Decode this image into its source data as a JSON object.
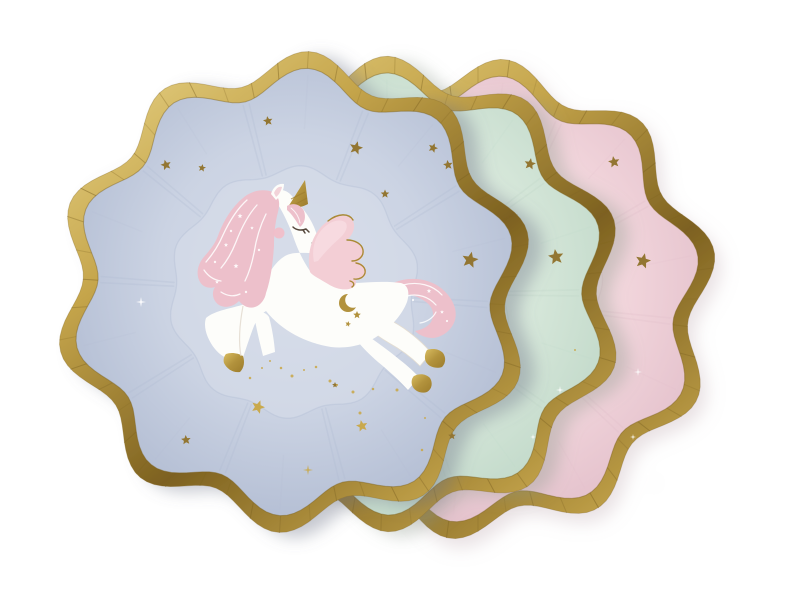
{
  "scene": {
    "background_color": "#ffffff",
    "gold": {
      "band_light": "#ecd98f",
      "band_mid": "#c5a54b",
      "band_dark": "#7d6120",
      "band_deep": "#8a6d25",
      "tick": "#7e6322",
      "star": "#937630",
      "star_bright": "#c9a94e"
    },
    "waves": {
      "count": 10,
      "amplitude": 0.066,
      "rim_scale": 0.93,
      "well_scale": 0.54
    },
    "plates": [
      {
        "id": "pink-plate",
        "depth": "back",
        "color": "#f3d7dd",
        "light": "#f8e3e7",
        "shade": "#e0bcc8",
        "cx": 478,
        "cy": 299,
        "r": 226,
        "phase": 0.2,
        "shadow": {
          "dx": 6,
          "dy": 9,
          "blur": 9,
          "color": "#b49aa2",
          "opacity": 0.3
        },
        "stars": [
          {
            "x": 614,
            "y": 162,
            "r": 6,
            "rot": -10
          },
          {
            "x": 643,
            "y": 261,
            "r": 8,
            "rot": 14
          }
        ],
        "sparkles": [
          {
            "x": 638,
            "y": 372,
            "r": 4,
            "color": "white"
          },
          {
            "x": 633,
            "y": 437,
            "r": 3,
            "color": "white"
          },
          {
            "x": 648,
            "y": 474,
            "r": 3.5,
            "color": "white"
          }
        ],
        "dots": []
      },
      {
        "id": "mint-plate",
        "depth": "middle",
        "color": "#d9e9dc",
        "light": "#e4f1e5",
        "shade": "#bdd6c6",
        "cx": 388,
        "cy": 294,
        "r": 223,
        "phase": 0.32,
        "shadow": {
          "dx": 13,
          "dy": 5,
          "blur": 8,
          "color": "#8f9c91",
          "opacity": 0.38
        },
        "stars": [
          {
            "x": 530,
            "y": 164,
            "r": 6,
            "rot": 10
          },
          {
            "x": 556,
            "y": 257,
            "r": 8,
            "rot": -8
          }
        ],
        "sparkles": [
          {
            "x": 560,
            "y": 390,
            "r": 4,
            "color": "white"
          },
          {
            "x": 533,
            "y": 437,
            "r": 3,
            "color": "white"
          }
        ],
        "dots": [
          [
            575,
            350
          ]
        ]
      },
      {
        "id": "blue-plate",
        "depth": "front",
        "color": "#cbd3e3",
        "light": "#d7ddea",
        "shade": "#aeb9d0",
        "cx": 294,
        "cy": 292,
        "r": 226,
        "phase": 0.25,
        "shadow": {
          "dx": 14,
          "dy": 5,
          "blur": 8,
          "color": "#6e7488",
          "opacity": 0.4
        },
        "stars": [
          {
            "x": 268,
            "y": 121,
            "r": 5,
            "rot": -10
          },
          {
            "x": 356,
            "y": 148,
            "r": 7,
            "rot": 15
          },
          {
            "x": 385,
            "y": 194,
            "r": 4.5,
            "rot": 0
          },
          {
            "x": 433,
            "y": 148,
            "r": 5,
            "rot": 20
          },
          {
            "x": 448,
            "y": 165,
            "r": 5,
            "rot": -8
          },
          {
            "x": 166,
            "y": 165,
            "r": 5.5,
            "rot": -15
          },
          {
            "x": 202,
            "y": 168,
            "r": 4,
            "rot": 10
          },
          {
            "x": 470,
            "y": 260,
            "r": 8.5,
            "rot": 12
          },
          {
            "x": 186,
            "y": 440,
            "r": 5,
            "rot": -5
          },
          {
            "x": 258,
            "y": 407,
            "r": 7,
            "rot": 20,
            "bright": true
          },
          {
            "x": 362,
            "y": 426,
            "r": 6,
            "rot": -12,
            "bright": true
          },
          {
            "x": 452,
            "y": 436,
            "r": 4,
            "rot": 0
          },
          {
            "x": 335,
            "y": 385,
            "r": 3,
            "rot": 0
          }
        ],
        "sparkles": [
          {
            "x": 141,
            "y": 302,
            "r": 5,
            "color": "white"
          },
          {
            "x": 308,
            "y": 470,
            "r": 5,
            "color": "gold"
          }
        ],
        "dots": [
          [
            270,
            361
          ],
          [
            281,
            368
          ],
          [
            292,
            376
          ],
          [
            304,
            370
          ],
          [
            316,
            367
          ],
          [
            330,
            381
          ],
          [
            337,
            385
          ],
          [
            373,
            389
          ],
          [
            353,
            392
          ],
          [
            262,
            368
          ],
          [
            250,
            378
          ],
          [
            397,
            390
          ],
          [
            425,
            418
          ],
          [
            422,
            450
          ],
          [
            360,
            413
          ]
        ]
      }
    ],
    "unicorn": {
      "body_color": "#fdfdfa",
      "mane_color": "#edc0cb",
      "mane_detail_color": "#ffffff",
      "wing_color": "#f3ced5",
      "wing_light_color": "#f7dde2",
      "wing_outline_color": "#aa8a35",
      "cheek_color": "#f3bdc8",
      "eye_color": "#54463b",
      "gold": "#b2923c",
      "gold_light": "#d9bd62",
      "gold_dark": "#9c7c2c",
      "crease_color": "#e4ddd1",
      "mane_stars": [
        [
          240,
          216,
          2.6
        ],
        [
          226,
          245,
          2.2
        ],
        [
          236,
          266,
          2.6
        ],
        [
          217,
          282,
          2
        ],
        [
          252,
          228,
          1.8
        ]
      ],
      "mane_dots": [
        [
          231,
          231
        ],
        [
          215,
          262
        ],
        [
          246,
          292
        ],
        [
          259,
          250
        ]
      ],
      "tail_stars": [
        [
          429,
          291,
          2.4
        ],
        [
          442,
          312,
          2
        ]
      ],
      "tail_dots": [
        [
          413,
          300
        ],
        [
          447,
          321
        ]
      ],
      "hip_stars": [
        [
          357,
          315,
          4,
          0
        ],
        [
          348,
          324,
          3,
          15
        ]
      ]
    }
  }
}
